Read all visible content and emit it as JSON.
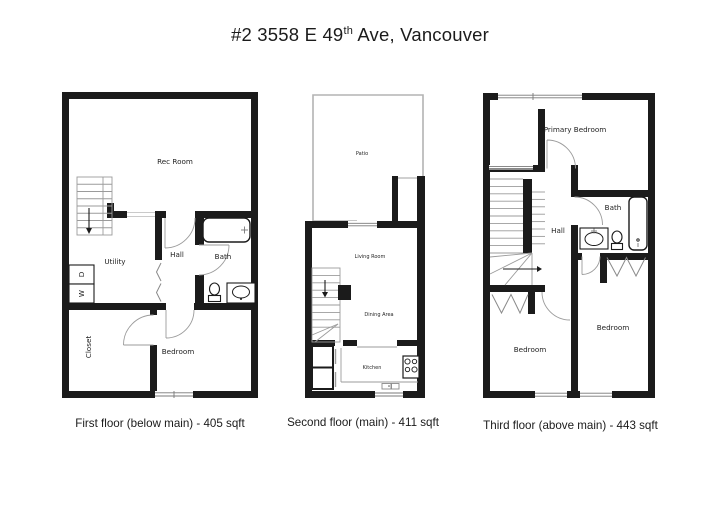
{
  "title": {
    "prefix": "#2 3558 E 49",
    "superscript": "th",
    "suffix": " Ave, Vancouver"
  },
  "floor1": {
    "caption": "First floor (below main) - 405 sqft",
    "rooms": {
      "rec_room": "Rec Room",
      "utility": "Utility",
      "hall": "Hall",
      "bath": "Bath",
      "closet": "Closet",
      "bedroom": "Bedroom",
      "dryer": "D",
      "washer": "W"
    }
  },
  "floor2": {
    "caption": "Second floor (main) - 411 sqft",
    "rooms": {
      "patio": "Patio",
      "living_room": "Living Room",
      "dining_area": "Dining Area",
      "kitchen": "Kitchen"
    }
  },
  "floor3": {
    "caption": "Third floor (above main) - 443 sqft",
    "rooms": {
      "primary_bedroom": "Primary Bedroom",
      "hall": "Hall",
      "bath": "Bath",
      "bedroom_left": "Bedroom",
      "bedroom_right": "Bedroom"
    }
  },
  "colors": {
    "wall": "#1b1b1b",
    "thin_line": "#9b9b9b",
    "background": "#ffffff",
    "text": "#1f1f1f"
  }
}
